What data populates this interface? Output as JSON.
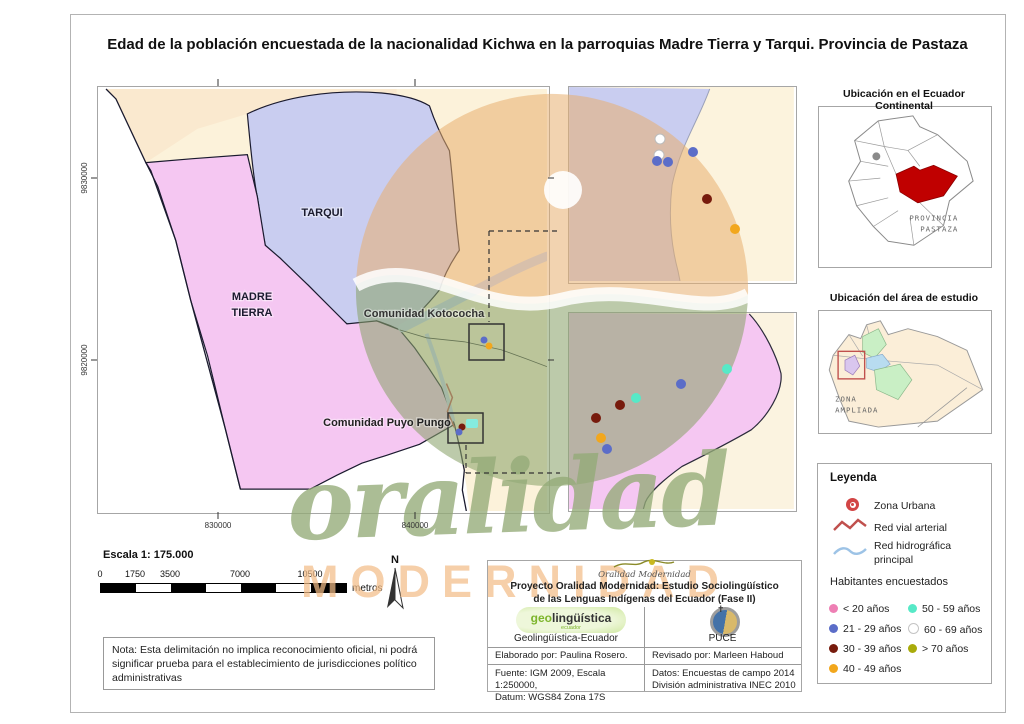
{
  "title": "Edad de la población encuestada de la nacionalidad Kichwa en la parroquias Madre Tierra y Tarqui. Provincia de Pastaza",
  "axes": {
    "y_ticks": [
      "9830000",
      "9820000"
    ],
    "x_ticks": [
      "830000",
      "840000"
    ]
  },
  "map_labels": {
    "tarqui": "TARQUI",
    "madre_l1": "MADRE",
    "madre_l2": "TIERRA",
    "kotococha": "Comunidad Kotococha",
    "puyo_pungo": "Comunidad Puyo Pungo"
  },
  "insets": {
    "ecuador": {
      "title": "Ubicación en el Ecuador Continental",
      "label_l1": "PROVINCIA",
      "label_l2": "PASTAZA",
      "highlight_color": "#c00000"
    },
    "area": {
      "title": "Ubicación del área de estudio",
      "label_l1": "ZONA",
      "label_l2": "AMPLIADA",
      "box_color": "#c0504d"
    }
  },
  "legend": {
    "heading": "Leyenda",
    "items": [
      {
        "label": "Zona Urbana",
        "color": "#d24545"
      },
      {
        "label": "Red vial arterial",
        "color": "#c0504d"
      },
      {
        "label_l1": "Red hidrográfica",
        "label_l2": "principal",
        "color": "#9dc3e6"
      }
    ],
    "subheading": "Habitantes encuestados",
    "ages": [
      {
        "id": "lt20",
        "label": "< 20 años",
        "color": "#ee7fb4"
      },
      {
        "id": "a21",
        "label": "21 - 29 años",
        "color": "#5b6dc8"
      },
      {
        "id": "a30",
        "label": "30 - 39 años",
        "color": "#771b0d"
      },
      {
        "id": "a40",
        "label": "40 - 49 años",
        "color": "#f2a71d"
      },
      {
        "id": "a50",
        "label": "50 - 59 años",
        "color": "#57e9c7"
      },
      {
        "id": "a60",
        "label": "60 - 69 años",
        "color": "#ffffff"
      },
      {
        "id": "gt70",
        "label": "> 70 años",
        "color": "#a9ab0a"
      }
    ]
  },
  "map_points": {
    "kotococha_detail": [
      {
        "x": 660,
        "y": 139,
        "age": "a60"
      },
      {
        "x": 659,
        "y": 155,
        "age": "a60"
      },
      {
        "x": 657,
        "y": 161,
        "age": "a21"
      },
      {
        "x": 668,
        "y": 162,
        "age": "a21"
      },
      {
        "x": 693,
        "y": 152,
        "age": "a21"
      },
      {
        "x": 707,
        "y": 199,
        "age": "a30"
      },
      {
        "x": 735,
        "y": 229,
        "age": "a40"
      }
    ],
    "puyo_detail": [
      {
        "x": 727,
        "y": 369,
        "age": "a50"
      },
      {
        "x": 681,
        "y": 384,
        "age": "a21"
      },
      {
        "x": 636,
        "y": 398,
        "age": "a50"
      },
      {
        "x": 620,
        "y": 405,
        "age": "a30"
      },
      {
        "x": 596,
        "y": 418,
        "age": "a30"
      },
      {
        "x": 601,
        "y": 438,
        "age": "a40"
      },
      {
        "x": 607,
        "y": 449,
        "age": "a21"
      }
    ],
    "kotococha_overview": [
      {
        "x": 484,
        "y": 340,
        "age": "a21"
      },
      {
        "x": 489,
        "y": 346,
        "age": "a40"
      }
    ],
    "puyo_overview": [
      {
        "x": 462,
        "y": 427,
        "age": "a30"
      },
      {
        "x": 459,
        "y": 432,
        "age": "a21"
      }
    ]
  },
  "scale": {
    "heading": "Escala 1: 175.000",
    "ticks": [
      "0",
      "1750",
      "3500",
      "7000",
      "10500"
    ],
    "unit": "metros",
    "north": "N"
  },
  "note": "Nota: Esta delimitación no implica reconocimiento oficial, ni podrá significar prueba para el establecimiento de jurisdicciones político administrativas",
  "credits": {
    "logo_script": "Oralidad Modernidad",
    "line1": "Proyecto Oralidad Modernidad: Estudio Sociolingüístico",
    "line2": "de las Lenguas Indígenas del Ecuador  (Fase II)",
    "geo_logo": {
      "geo": "geo",
      "rest": "lingüística",
      "sub": "ecuador"
    },
    "geo_caption": "Geolingüística-Ecuador",
    "puce_caption": "PUCE",
    "elaborado": "Elaborado por: Paulina Rosero.",
    "revisado": "Revisado por: Marleen Haboud",
    "fuente_l1": "Fuente: IGM 2009, Escala 1:250000,",
    "fuente_l2": "Datum: WGS84 Zona 17S",
    "datos_l1": "Datos: Encuestas de campo 2014",
    "datos_l2": "División administrativa INEC 2010"
  },
  "watermark": {
    "script": "oralidad",
    "caps": "MODERNIDAD"
  }
}
